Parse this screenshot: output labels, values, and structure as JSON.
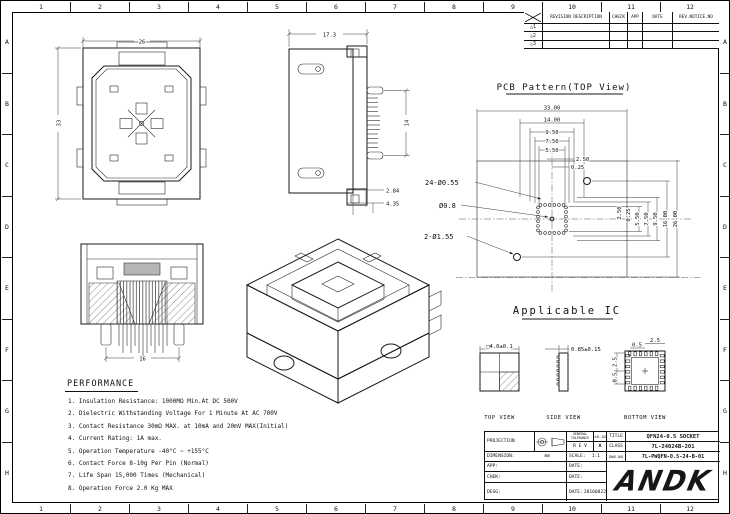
{
  "sheet": {
    "cols": [
      "1",
      "2",
      "3",
      "4",
      "5",
      "6",
      "7",
      "8",
      "9",
      "10",
      "11",
      "12"
    ],
    "rows": [
      "A",
      "B",
      "C",
      "D",
      "E",
      "F",
      "G",
      "H"
    ]
  },
  "revision_table": {
    "headers": [
      "REVISION DESCRIPTION",
      "CHECK",
      "APP",
      "DATE",
      "REV.NOTICE.NO"
    ],
    "row_marks": [
      "1",
      "2",
      "3"
    ]
  },
  "socket_views": {
    "top": {
      "width_dim": "26",
      "height_dim": "33"
    },
    "side": {
      "width_dim": "17.3",
      "pin_dim": "14",
      "step_dim_1": "2.84",
      "step_dim_2": "4.35"
    },
    "front": {
      "pitch_dim": "16"
    }
  },
  "pcb_pattern": {
    "title": "PCB Pattern(TOP View)",
    "dims_horizontal": [
      "33.00",
      "14.00",
      "9.50",
      "7.50",
      "5.50",
      "2.50",
      "0.25"
    ],
    "dims_vertical": [
      "2.50",
      "0.25",
      "5.50",
      "7.50",
      "9.50",
      "16.00",
      "26.00"
    ],
    "callouts": [
      "24-Ø0.55",
      "Ø0.8",
      "2-Ø1.55"
    ]
  },
  "applicable_ic": {
    "title": "Applicable IC",
    "views": [
      {
        "label": "TOP VIEW",
        "dim": "□4.0±0.1"
      },
      {
        "label": "SIDE VIEW",
        "dim": "0.85±0.15"
      },
      {
        "label": "BOTTOM VIEW",
        "dims": [
          "2.5",
          "0.5",
          "2.5",
          "0.5"
        ]
      }
    ]
  },
  "performance": {
    "title": "PERFORMANCE",
    "items": [
      "1. Insulation Resistance: 1000MΩ Min.At DC 500V",
      "2. Dielectric Withstanding Voltage For 1 Minute At AC 700V",
      "3. Contact Resistance 30mΩ MAX. at 10mA and 20mV MAX(Initial)",
      "4. Current Rating: 1A max.",
      "5. Operation Temperature -40°C ~ +155°C",
      "6. Contact Force 8-10g Per Pin (Normal)",
      "7. Life Span 15,000 Times (Mechanical)",
      "8. Operation Force 2.0 Kg MAX"
    ]
  },
  "title_block": {
    "projection_label": "PROJECTION",
    "tolerance_label": "GENERAL TOLERANCE",
    "tolerance_value": "±0.10",
    "rev_label": "R E V",
    "rev_value": "A",
    "title_label": "TITLE",
    "title_value": "QFN24-0.5 SOCKET",
    "class_label": "CLASS",
    "class_value": "7L-24024B-201",
    "dimension_label": "DIMENSION:",
    "dimension_value": "mm",
    "scale_label": "SCALE:",
    "scale_value": "1:1",
    "dwg_label": "DWG.NO",
    "dwg_value": "7L-PWQFN-0.5-24-B-01",
    "app_label": "APP:",
    "chek_label": "CHEK:",
    "desg_label": "DESG:",
    "date_label": "DATE:",
    "desg_date": "20160822",
    "logo": "ANDK"
  }
}
